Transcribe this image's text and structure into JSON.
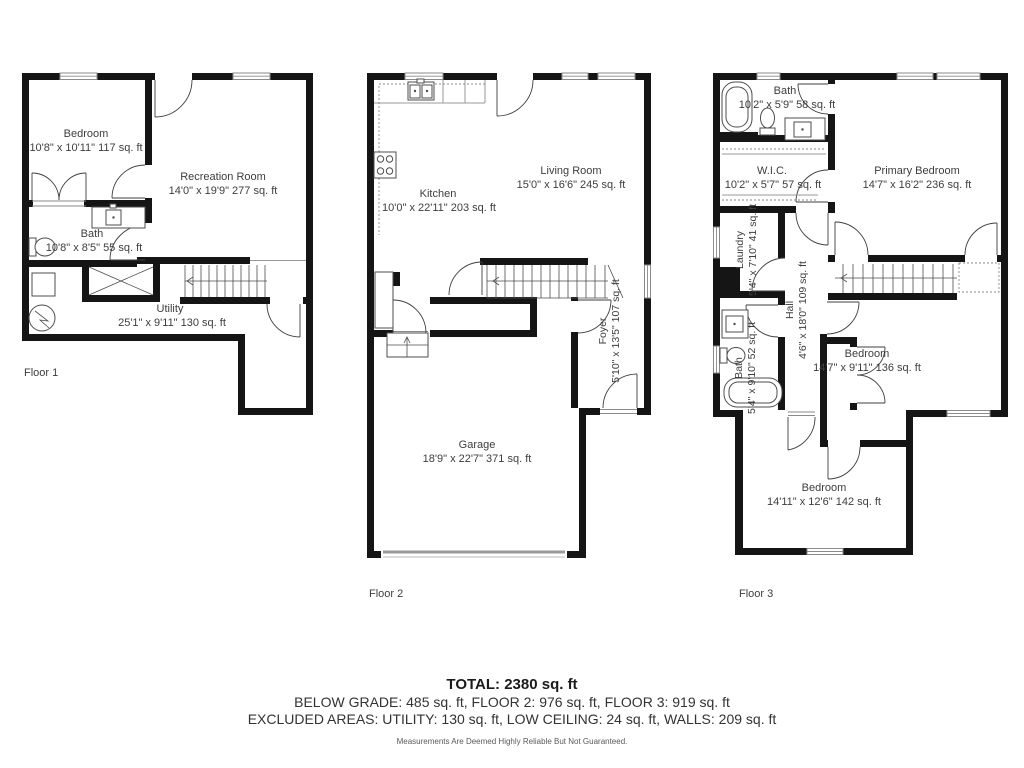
{
  "colors": {
    "wall": "#151515",
    "text": "#3d3d3d",
    "line": "#4d4d4d",
    "accent_gray": "#9a9a9a"
  },
  "floors": [
    {
      "label": "Floor 1",
      "rooms": [
        {
          "name": "Bedroom",
          "dims": "10'8\" x 10'11\" 117 sq. ft"
        },
        {
          "name": "Recreation Room",
          "dims": "14'0\" x 19'9\" 277 sq. ft"
        },
        {
          "name": "Bath",
          "dims": "10'8\" x 8'5\" 55 sq. ft"
        },
        {
          "name": "Utility",
          "dims": "25'1\" x 9'11\" 130 sq. ft"
        }
      ]
    },
    {
      "label": "Floor 2",
      "rooms": [
        {
          "name": "Kitchen",
          "dims": "10'0\" x 22'11\" 203 sq. ft"
        },
        {
          "name": "Living Room",
          "dims": "15'0\" x 16'6\" 245 sq. ft"
        },
        {
          "name": "Foyer",
          "dims": "5'10\" x 13'5\" 107 sq. ft"
        },
        {
          "name": "Garage",
          "dims": "18'9\" x 22'7\" 371 sq. ft"
        }
      ]
    },
    {
      "label": "Floor 3",
      "rooms": [
        {
          "name": "Bath",
          "dims": "10'2\" x 5'9\" 58 sq. ft"
        },
        {
          "name": "W.I.C.",
          "dims": "10'2\" x 5'7\" 57 sq. ft"
        },
        {
          "name": "Primary Bedroom",
          "dims": "14'7\" x 16'2\" 236 sq. ft"
        },
        {
          "name": "Laundry",
          "dims": "5'4\" x 7'10\" 41 sq. ft"
        },
        {
          "name": "Hall",
          "dims": "4'6\" x 18'0\" 109 sq. ft"
        },
        {
          "name": "Bath",
          "dims": "5'4\" x 9'10\" 52 sq. ft"
        },
        {
          "name": "Bedroom",
          "dims": "14'7\" x 9'11\" 136 sq. ft"
        },
        {
          "name": "Bedroom",
          "dims": "14'11\" x 12'6\" 142 sq. ft"
        }
      ]
    }
  ],
  "footer": {
    "total": "TOTAL: 2380 sq. ft",
    "line2": "BELOW GRADE: 485 sq. ft, FLOOR 2: 976 sq. ft, FLOOR 3: 919 sq. ft",
    "line3": "EXCLUDED AREAS: UTILITY: 130 sq. ft, LOW CEILING: 24 sq. ft, WALLS: 209 sq. ft",
    "disclaimer": "Measurements Are Deemed Highly Reliable But Not Guaranteed."
  }
}
